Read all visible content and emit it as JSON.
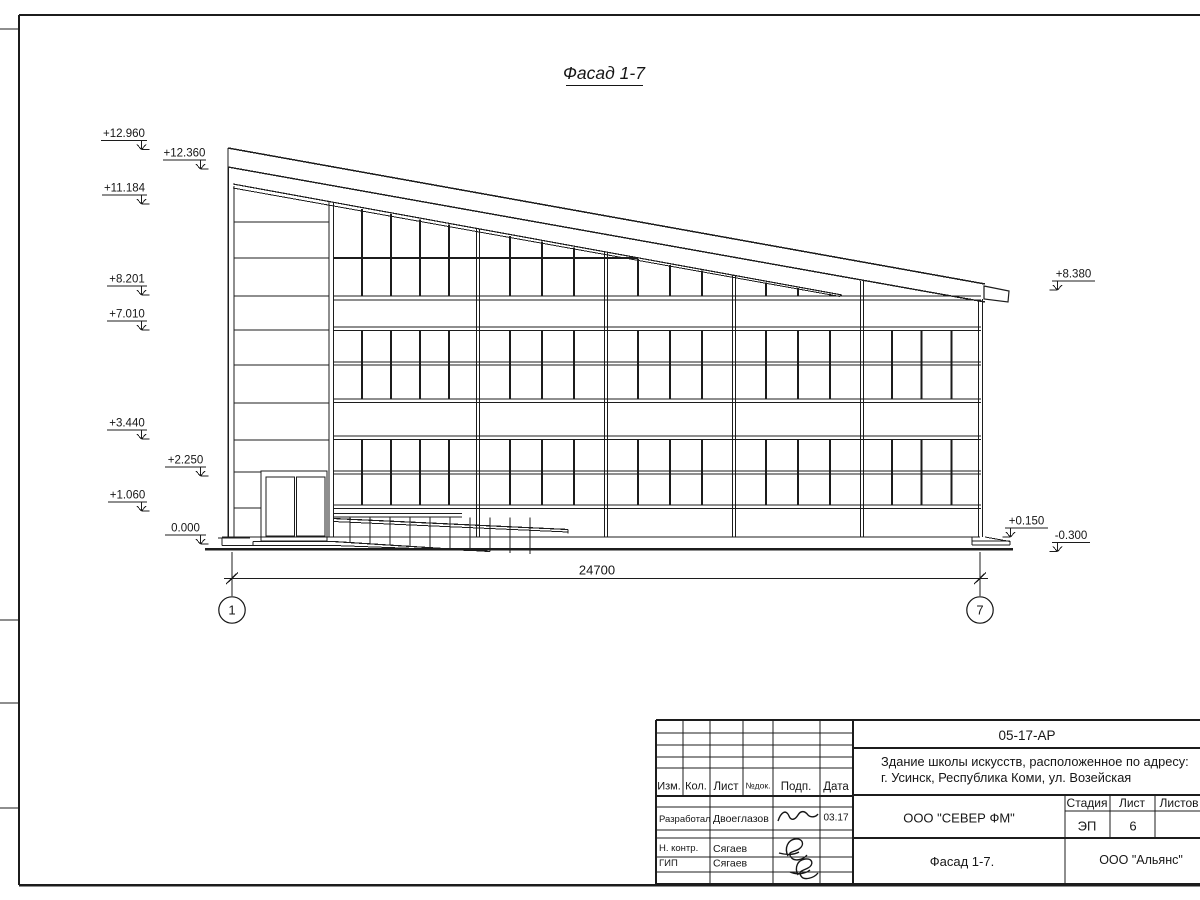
{
  "drawing": {
    "title": "Фасад 1-7",
    "dimension_label": "24700",
    "axis_left": "1",
    "axis_right": "7",
    "marks_left": [
      "+12.960",
      "+12.360",
      "+11.184",
      "+8.201",
      "+7.010",
      "+3.440",
      "+2.250",
      "+1.060",
      "0.000"
    ],
    "marks_right": [
      "+8.380",
      "+0.150",
      "-0.300"
    ]
  },
  "title_block": {
    "doc_code": "05-17-АР",
    "object_line1": "Здание школы искусств, расположенное по адресу:",
    "object_line2": "г. Усинск, Республика Коми, ул. Возейская",
    "cols": {
      "izm": "Изм.",
      "kol": "Кол.",
      "list": "Лист",
      "ndok": "№док.",
      "podp": "Подп.",
      "data": "Дата"
    },
    "rows": {
      "developed_role": "Разработал",
      "developed_name": "Двоеглазов",
      "developed_date": "03.17",
      "ncontr_role": "Н. контр.",
      "ncontr_name": "Сягаев",
      "gip_role": "ГИП",
      "gip_name": "Сягаев"
    },
    "company": "ООО \"СЕВЕР ФМ\"",
    "stage_label": "Стадия",
    "sheet_label": "Лист",
    "sheets_label": "Листов",
    "stage_value": "ЭП",
    "sheet_value": "6",
    "view_title": "Фасад 1-7.",
    "client": "ООО \"Альянс\""
  }
}
